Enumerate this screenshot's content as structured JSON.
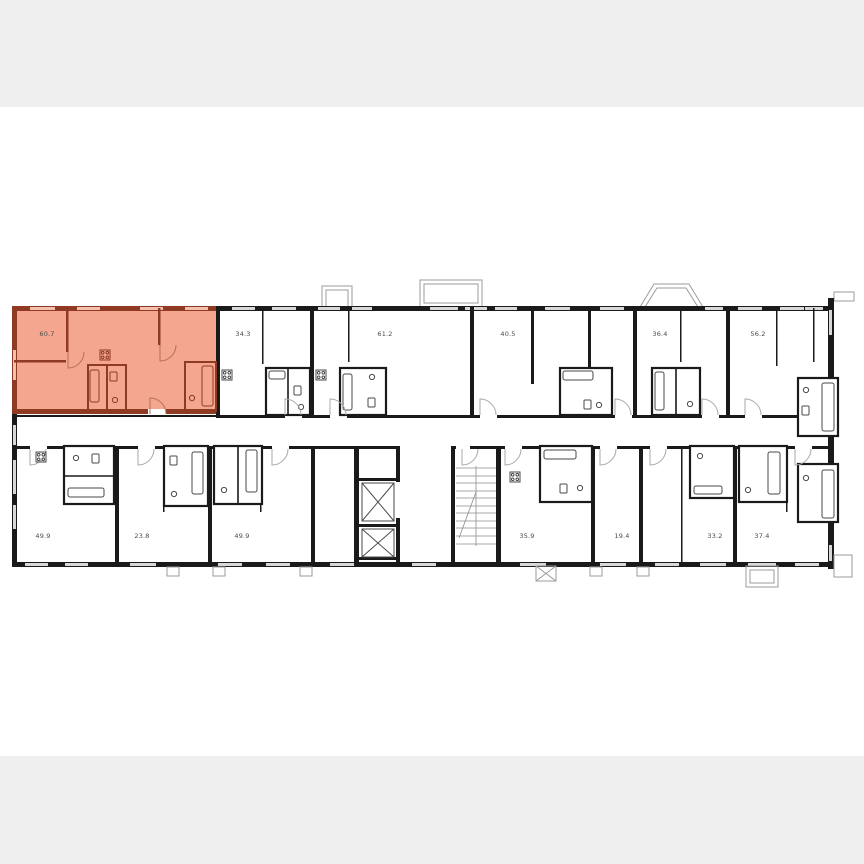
{
  "colors": {
    "letterbox": "#efefef",
    "canvas": "#ffffff",
    "wall": "#1a1a1a",
    "thin_line": "#9b9b9b",
    "window": "#d8d8d8",
    "highlight_fill": "#f4a68f",
    "highlight_wall": "#8f3a22",
    "highlight_window": "#f3c0ae",
    "label_text": "#4a4a4a"
  },
  "plan": {
    "type": "residential-floor-plan",
    "highlighted_unit": {
      "area": "60.7"
    },
    "units": [
      {
        "area": "60.7",
        "row": "top",
        "position": 1,
        "highlighted": true
      },
      {
        "area": "34.3",
        "row": "top",
        "position": 2,
        "highlighted": false
      },
      {
        "area": "61.2",
        "row": "top",
        "position": 3,
        "highlighted": false
      },
      {
        "area": "40.5",
        "row": "top",
        "position": 4,
        "highlighted": false
      },
      {
        "area": "36.4",
        "row": "top",
        "position": 5,
        "highlighted": false
      },
      {
        "area": "56.2",
        "row": "top",
        "position": 6,
        "highlighted": false
      },
      {
        "area": "49.9",
        "row": "bottom",
        "position": 1,
        "highlighted": false
      },
      {
        "area": "23.8",
        "row": "bottom",
        "position": 2,
        "highlighted": false
      },
      {
        "area": "49.9",
        "row": "bottom",
        "position": 3,
        "highlighted": false
      },
      {
        "area": "35.9",
        "row": "bottom",
        "position": 4,
        "highlighted": false
      },
      {
        "area": "19.4",
        "row": "bottom",
        "position": 5,
        "highlighted": false
      },
      {
        "area": "33.2",
        "row": "bottom",
        "position": 6,
        "highlighted": false
      },
      {
        "area": "37.4",
        "row": "bottom",
        "position": 7,
        "highlighted": false
      }
    ],
    "core": {
      "elevator_count": 2,
      "staircase": true
    }
  }
}
